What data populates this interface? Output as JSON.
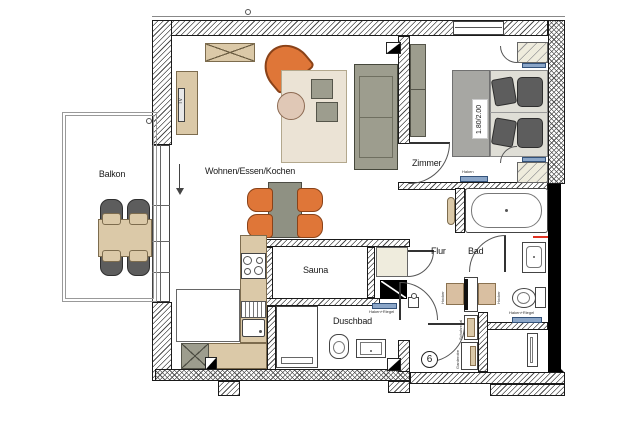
{
  "plan": {
    "labels": {
      "balkon": "Balkon",
      "wohnen": "Wohnen/Essen/Kochen",
      "zimmer": "Zimmer",
      "sauna": "Sauna",
      "flur": "Flur",
      "bad": "Bad",
      "duschbad": "Duschbad"
    },
    "annotations": {
      "bed_size": "1.80/2.00",
      "tv": "TV",
      "unit_number": "6",
      "haken": "Haken",
      "haken_riegel_flur": "Haken+Riegel",
      "haken_riegel_bad": "Haken+Riegel",
      "hocker_left": "Hocker",
      "hocker_right": "Hocker",
      "shelf_upper": "Schuhregal",
      "shelf_lower": "Garderobe"
    },
    "colors": {
      "wood_beige": "#dbc9a8",
      "cream_wardrobe": "#efecdd",
      "accent_orange": "#df7638",
      "sofa_green_gray": "#9d9d8e",
      "dark_gray_furniture": "#5d5d5d",
      "blue_fitting": "#8ba6c8",
      "wall_black": "#000000",
      "red_marker": "#e03323"
    }
  }
}
